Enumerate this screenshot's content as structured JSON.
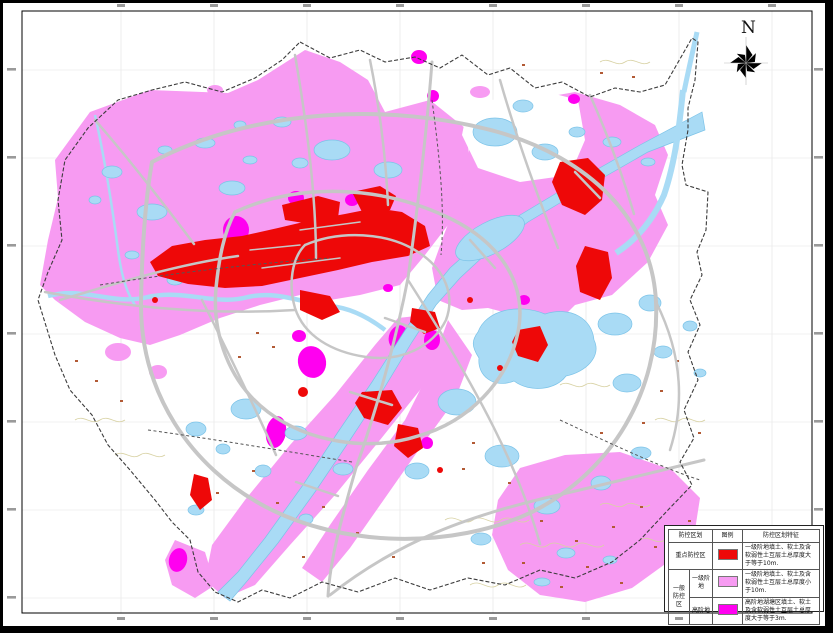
{
  "colors": {
    "pink": "#f79bf2",
    "magenta": "#ff00f0",
    "red": "#ee0808",
    "water": "#a9dbf5",
    "waterline": "#7cc3e8",
    "road": "#c6c6c6",
    "boundary": "#3c3c3c",
    "grid": "#e3e3e3",
    "contour": "#d8d2a4",
    "speck": "#b25a35"
  },
  "north_arrow": {
    "label": "N"
  },
  "legend": {
    "headers": {
      "zoning": "防控区划",
      "symbol": "图例",
      "feature": "防控区划特征"
    },
    "rows": [
      {
        "zone": "重点防控区",
        "terrace": "",
        "desc": "一级阶地填土、软土及含软弱性土互层土总厚度大于等于10m."
      },
      {
        "zone": "一般防控区",
        "terrace": "一级阶地",
        "desc": "一级阶地填土、软土及含软弱性土互层土总厚度小于10m."
      },
      {
        "zone": "一般防控区",
        "terrace": "高阶地",
        "desc": "高阶地湖塘区填土、软土及含软弱性土互层土总厚度大于等于3m."
      }
    ]
  }
}
